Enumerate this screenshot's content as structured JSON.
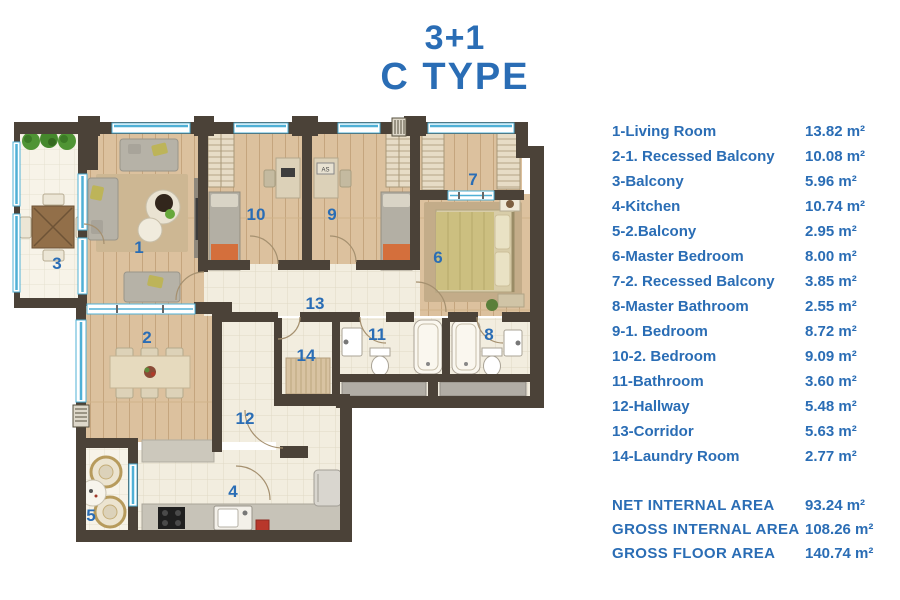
{
  "title": {
    "line1": "3+1",
    "line2": "C TYPE"
  },
  "colors": {
    "accent": "#2a6db5",
    "wall": "#4b4238",
    "window": "#4fb0d6",
    "wood_floor": "#dcc19e",
    "tile_floor": "#f2eddf",
    "shaft_gray": "#b1ada5",
    "orange_accent": "#d46f3c"
  },
  "legend": {
    "rooms": [
      {
        "label": "1-Living Room",
        "area": "13.82 m²"
      },
      {
        "label": "2-1. Recessed Balcony",
        "area": "10.08 m²"
      },
      {
        "label": "3-Balcony",
        "area": "5.96 m²"
      },
      {
        "label": "4-Kitchen",
        "area": "10.74 m²"
      },
      {
        "label": "5-2.Balcony",
        "area": "2.95 m²"
      },
      {
        "label": "6-Master Bedroom",
        "area": "8.00 m²"
      },
      {
        "label": "7-2. Recessed Balcony",
        "area": "3.85 m²"
      },
      {
        "label": "8-Master Bathroom",
        "area": "2.55 m²"
      },
      {
        "label": "9-1. Bedroom",
        "area": "8.72 m²"
      },
      {
        "label": "10-2. Bedroom",
        "area": "9.09 m²"
      },
      {
        "label": "11-Bathroom",
        "area": "3.60 m²"
      },
      {
        "label": "12-Hallway",
        "area": "5.48 m²"
      },
      {
        "label": "13-Corridor",
        "area": "5.63 m²"
      },
      {
        "label": "14-Laundry Room",
        "area": "2.77 m²"
      }
    ],
    "totals": [
      {
        "label": "NET INTERNAL AREA",
        "value": "93.24 m²"
      },
      {
        "label": "GROSS INTERNAL AREA",
        "value": "108.26 m²"
      },
      {
        "label": "GROSS FLOOR AREA",
        "value": "140.74 m²"
      }
    ]
  },
  "plan": {
    "labels": {
      "r1": "1",
      "r2": "2",
      "r3": "3",
      "r4": "4",
      "r5": "5",
      "r6": "6",
      "r7": "7",
      "r8": "8",
      "r9": "9",
      "r10": "10",
      "r11": "11",
      "r12": "12",
      "r13": "13",
      "r14": "14"
    },
    "desk_text": "AS"
  }
}
